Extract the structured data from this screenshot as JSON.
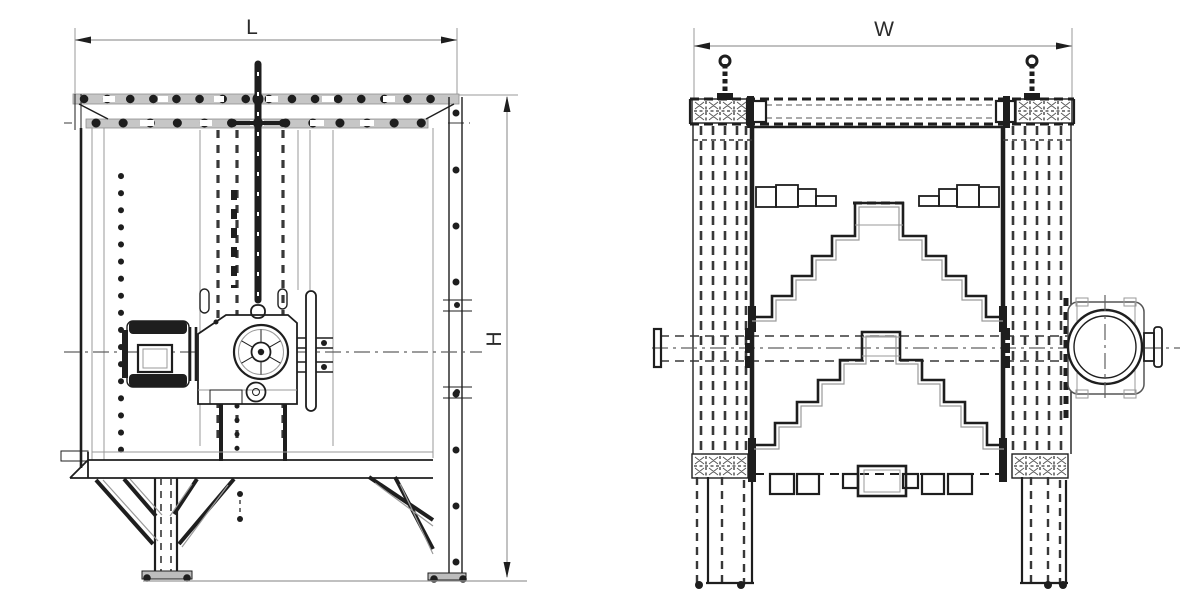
{
  "drawing_type": "two-view technical dimension drawing",
  "dimensions": {
    "length_label": "L",
    "width_label": "W",
    "height_label": "H"
  },
  "colors": {
    "background": "#ffffff",
    "line": "#1e1e1e",
    "line_light": "#9a9a9a",
    "hidden": "#383838",
    "band_fill": "#c6c6c6",
    "centerline": "#606060",
    "text": "#2b2b2b"
  }
}
